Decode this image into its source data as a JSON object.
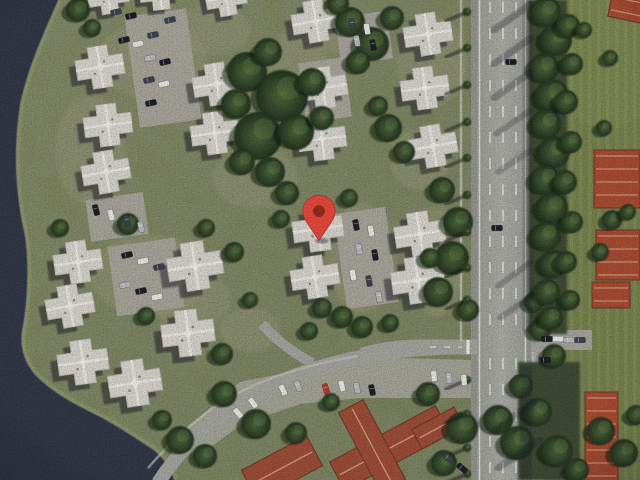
{
  "map": {
    "kind": "satellite-imagery",
    "marker": {
      "x": 319,
      "y": 218,
      "body_color": "#e8473a",
      "rim_color": "#b5352b",
      "dot_color": "#8e2418"
    },
    "palette": {
      "land_a": "#83865c",
      "land_b": "#747a51",
      "ground_patch": "#a69e7c",
      "water": "#2f3545",
      "water_edge": "#4a5370",
      "shore": "#8f9468",
      "grass_right": "#75814b",
      "grass_bright": "#7d8a50",
      "road": "#a4a49f",
      "road_shoulder": "#94948d",
      "lane": "#ffffff",
      "parking": "#a7a49a",
      "sidewalk": "#c6c3ba",
      "median_base": "#3c4a30",
      "building_roof": "#d7d5cd",
      "building_edge": "#b2b0a7",
      "building_ridge": "#efede6",
      "building_shadow": "rgba(22,26,36,0.5)",
      "red_roof": "#9c4b36",
      "red_roof_bright": "#a84a30",
      "red_ridge": "#dca88c",
      "red_edge": "#6f3425",
      "tree_shadow": "rgba(12,17,12,0.5)",
      "palm_canopy": "#2c4024",
      "car_colors": {
        "w": "#e9e9e7",
        "s": "#b9bcc0",
        "d": "#3a4150",
        "k": "#181c26",
        "r": "#b5382c"
      }
    },
    "water_shape": {
      "shore_line": "M58,0 C44,32 28,66 20,104 C13,148 15,192 24,232 C29,258 28,300 22,330 C19,348 25,364 36,376 C52,392 72,403 92,413 C113,423 133,437 152,449 C164,458 170,468 174,480",
      "lake_fill": "M0,0 L58,0 C44,32 28,66 20,104 C13,148 15,192 24,232 C29,258 28,300 22,330 C19,348 25,364 36,376 C52,392 72,403 92,413 C113,423 133,437 152,449 C164,458 170,468 174,480 L0,480 Z"
    },
    "ground_patches": [
      [
        152,
        60,
        55,
        38
      ],
      [
        150,
        275,
        60,
        40
      ],
      [
        362,
        258,
        34,
        55
      ],
      [
        350,
        34,
        32,
        24
      ],
      [
        255,
        178,
        42,
        30
      ],
      [
        432,
        62,
        35,
        45
      ],
      [
        436,
        262,
        26,
        55
      ],
      [
        90,
        150,
        35,
        55
      ],
      [
        190,
        300,
        40,
        30
      ],
      [
        300,
        70,
        30,
        45
      ],
      [
        420,
        160,
        30,
        30
      ],
      [
        210,
        30,
        40,
        25
      ],
      [
        250,
        330,
        30,
        22
      ]
    ],
    "parking_lots": [
      {
        "x": 132,
        "y": 12,
        "w": 62,
        "h": 112,
        "rot": -8
      },
      {
        "x": 88,
        "y": 196,
        "w": 58,
        "h": 42,
        "rot": -8
      },
      {
        "x": 112,
        "y": 242,
        "w": 68,
        "h": 70,
        "rot": -8
      },
      {
        "x": 340,
        "y": 210,
        "w": 52,
        "h": 96,
        "rot": -8
      },
      {
        "x": 338,
        "y": 14,
        "w": 52,
        "h": 48,
        "rot": -8
      },
      {
        "x": 302,
        "y": 60,
        "w": 46,
        "h": 60,
        "rot": -8
      },
      {
        "x": 536,
        "y": 330,
        "w": 56,
        "h": 20,
        "rot": 0
      }
    ],
    "parking_arc": "M182,432 L240,382 L330,364 L400,358 L472,360 L472,398 L360,398 L300,404 L242,424 L204,452 Z",
    "roads": {
      "highway_shoulder": {
        "x": 471,
        "w": 62
      },
      "highway": {
        "x": 477,
        "w": 50
      },
      "pocket": {
        "x": 531,
        "y": 316,
        "w": 12,
        "h": 164
      },
      "lane_xs": [
        490,
        503,
        516
      ],
      "edge_xs": [
        479.5,
        525.5
      ],
      "cross_path": "M477,347 L420,347 C400,347 380,350 362,355",
      "arc_path": "M158,483 C178,452 208,421 244,400 C282,378 322,364 366,356 C404,349 442,347 477,347",
      "stub_path": "M312,363 C292,352 276,340 262,324",
      "sidewalk_left": "M461,0 L461,342",
      "sidewalk_right": "M533,352 L533,480",
      "sidewalk_arc": "M148,468 C172,440 200,414 236,394 C270,376 310,364 358,356",
      "stop_bar": [
        468,
        340,
        468,
        354
      ],
      "cross_dashes": [
        430,
        347,
        462,
        347
      ]
    },
    "median_blocks": [
      [
        529,
        0,
        38,
        334
      ],
      [
        518,
        362,
        62,
        118
      ]
    ],
    "grass_right": {
      "x": 536,
      "w": 104
    },
    "grass_bright_patch": {
      "cx": 608,
      "cy": 55,
      "rx": 62,
      "ry": 72
    },
    "red_edge_buildings": [
      {
        "x": 610,
        "y": -6,
        "w": 34,
        "h": 26,
        "rot": 12
      },
      {
        "x": 594,
        "y": 150,
        "w": 46,
        "h": 58,
        "rot": 0
      },
      {
        "x": 596,
        "y": 230,
        "w": 44,
        "h": 50,
        "rot": 0
      },
      {
        "x": 592,
        "y": 282,
        "w": 38,
        "h": 26,
        "rot": 0
      },
      {
        "x": 585,
        "y": 392,
        "w": 33,
        "h": 92,
        "rot": 0
      }
    ],
    "red_complex": [
      {
        "cx": 390,
        "cy": 448,
        "w": 120,
        "h": 32,
        "rot": -28
      },
      {
        "cx": 372,
        "cy": 446,
        "w": 90,
        "h": 28,
        "rot": 62
      },
      {
        "cx": 438,
        "cy": 428,
        "w": 48,
        "h": 22,
        "rot": -28
      },
      {
        "cx": 282,
        "cy": 468,
        "w": 74,
        "h": 34,
        "rot": -28
      }
    ],
    "buildings": [
      {
        "x": 108,
        "y": -4,
        "rot": -9,
        "s": 0.85
      },
      {
        "x": 160,
        "y": -8,
        "rot": -6,
        "s": 0.85
      },
      {
        "x": 226,
        "y": -2,
        "rot": -10,
        "s": 0.85
      },
      {
        "x": 100,
        "y": 67,
        "rot": -9,
        "s": 1
      },
      {
        "x": 108,
        "y": 125,
        "rot": -7,
        "s": 1
      },
      {
        "x": 106,
        "y": 172,
        "rot": -10,
        "s": 1
      },
      {
        "x": 217,
        "y": 84,
        "rot": -9,
        "s": 1
      },
      {
        "x": 215,
        "y": 133,
        "rot": -8,
        "s": 1
      },
      {
        "x": 316,
        "y": 21,
        "rot": -10,
        "s": 1
      },
      {
        "x": 323,
        "y": 88,
        "rot": -9,
        "s": 1
      },
      {
        "x": 322,
        "y": 139,
        "rot": -7,
        "s": 1
      },
      {
        "x": 428,
        "y": 34,
        "rot": -9,
        "s": 1
      },
      {
        "x": 425,
        "y": 88,
        "rot": -8,
        "s": 1
      },
      {
        "x": 433,
        "y": 146,
        "rot": -10,
        "s": 1
      },
      {
        "x": 78,
        "y": 262,
        "rot": -8,
        "s": 1
      },
      {
        "x": 70,
        "y": 306,
        "rot": -10,
        "s": 1
      },
      {
        "x": 83,
        "y": 362,
        "rot": -8,
        "s": 1.05
      },
      {
        "x": 195,
        "y": 266,
        "rot": -9,
        "s": 1.15
      },
      {
        "x": 188,
        "y": 333,
        "rot": -7,
        "s": 1.1
      },
      {
        "x": 135,
        "y": 383,
        "rot": -9,
        "s": 1.1
      },
      {
        "x": 318,
        "y": 229,
        "rot": -8,
        "s": 1.05
      },
      {
        "x": 315,
        "y": 277,
        "rot": -9,
        "s": 1
      },
      {
        "x": 420,
        "y": 234,
        "rot": -9,
        "s": 1.05
      },
      {
        "x": 418,
        "y": 280,
        "rot": -8,
        "s": 1.1
      }
    ],
    "trees": [
      [
        247,
        72,
        20
      ],
      [
        282,
        96,
        26
      ],
      [
        258,
        136,
        24
      ],
      [
        296,
        132,
        18
      ],
      [
        236,
        104,
        15
      ],
      [
        312,
        82,
        14
      ],
      [
        268,
        52,
        14
      ],
      [
        322,
        118,
        12
      ],
      [
        242,
        162,
        13
      ],
      [
        270,
        172,
        15
      ],
      [
        350,
        22,
        15
      ],
      [
        372,
        44,
        17
      ],
      [
        392,
        18,
        12
      ],
      [
        358,
        62,
        12
      ],
      [
        338,
        4,
        11
      ],
      [
        388,
        128,
        14
      ],
      [
        404,
        152,
        11
      ],
      [
        378,
        106,
        10
      ],
      [
        287,
        193,
        12
      ],
      [
        281,
        219,
        9
      ],
      [
        349,
        198,
        9
      ],
      [
        442,
        190,
        13
      ],
      [
        458,
        222,
        15
      ],
      [
        452,
        258,
        17
      ],
      [
        438,
        292,
        15
      ],
      [
        468,
        310,
        11
      ],
      [
        430,
        258,
        10
      ],
      [
        322,
        308,
        10
      ],
      [
        342,
        317,
        11
      ],
      [
        362,
        327,
        11
      ],
      [
        390,
        323,
        9
      ],
      [
        309,
        331,
        9
      ],
      [
        128,
        224,
        11
      ],
      [
        146,
        316,
        9
      ],
      [
        60,
        228,
        9
      ],
      [
        222,
        354,
        11
      ],
      [
        234,
        252,
        10
      ],
      [
        206,
        228,
        9
      ],
      [
        250,
        300,
        8
      ],
      [
        78,
        10,
        12
      ],
      [
        92,
        28,
        9
      ],
      [
        180,
        440,
        14
      ],
      [
        162,
        420,
        10
      ],
      [
        205,
        456,
        12
      ],
      [
        224,
        394,
        13
      ],
      [
        256,
        424,
        15
      ],
      [
        296,
        433,
        11
      ],
      [
        331,
        402,
        9
      ],
      [
        428,
        394,
        12
      ],
      [
        462,
        428,
        16
      ],
      [
        444,
        463,
        13
      ],
      [
        498,
        420,
        15
      ],
      [
        517,
        443,
        17
      ],
      [
        538,
        412,
        14
      ],
      [
        557,
        451,
        16
      ],
      [
        577,
        470,
        12
      ],
      [
        601,
        431,
        14
      ],
      [
        624,
        453,
        14
      ],
      [
        636,
        415,
        10
      ],
      [
        540,
        330,
        11
      ],
      [
        554,
        356,
        12
      ],
      [
        521,
        386,
        12
      ],
      [
        534,
        302,
        10
      ],
      [
        546,
        12,
        15
      ],
      [
        556,
        40,
        16
      ],
      [
        544,
        68,
        15
      ],
      [
        552,
        96,
        17
      ],
      [
        546,
        124,
        15
      ],
      [
        554,
        152,
        16
      ],
      [
        545,
        180,
        15
      ],
      [
        552,
        208,
        16
      ],
      [
        546,
        236,
        15
      ],
      [
        553,
        264,
        14
      ],
      [
        547,
        292,
        13
      ],
      [
        551,
        318,
        12
      ],
      [
        568,
        26,
        12
      ],
      [
        572,
        64,
        11
      ],
      [
        566,
        102,
        12
      ],
      [
        571,
        142,
        11
      ],
      [
        565,
        182,
        12
      ],
      [
        572,
        222,
        11
      ],
      [
        566,
        262,
        11
      ],
      [
        570,
        300,
        10
      ],
      [
        584,
        30,
        8
      ],
      [
        604,
        128,
        8
      ],
      [
        612,
        220,
        10
      ],
      [
        600,
        252,
        9
      ],
      [
        628,
        212,
        8
      ],
      [
        610,
        58,
        8
      ]
    ],
    "palms": [
      [
        467,
        12
      ],
      [
        467,
        48
      ],
      [
        467,
        85
      ],
      [
        467,
        122
      ],
      [
        467,
        158
      ],
      [
        467,
        195
      ],
      [
        467,
        232
      ],
      [
        467,
        268
      ],
      [
        467,
        300
      ],
      [
        467,
        380
      ],
      [
        467,
        414
      ],
      [
        467,
        448
      ],
      [
        467,
        474
      ]
    ],
    "shadow_streaks": [
      [
        531,
        4,
        494,
        30,
        7,
        0.3
      ],
      [
        531,
        38,
        494,
        64,
        7,
        0.3
      ],
      [
        531,
        72,
        494,
        98,
        7,
        0.28
      ],
      [
        531,
        110,
        496,
        134,
        6,
        0.25
      ],
      [
        531,
        150,
        498,
        172,
        6,
        0.22
      ],
      [
        531,
        262,
        498,
        286,
        6,
        0.25
      ],
      [
        531,
        296,
        500,
        318,
        6,
        0.25
      ],
      [
        533,
        402,
        496,
        430,
        7,
        0.3
      ],
      [
        540,
        440,
        498,
        468,
        7,
        0.3
      ]
    ],
    "shadow_bands": [
      [
        523,
        0,
        9,
        332,
        0.25
      ],
      [
        520,
        366,
        12,
        114,
        0.25
      ]
    ],
    "cars": [
      [
        124,
        40,
        -12,
        "k"
      ],
      [
        138,
        44,
        -12,
        "w"
      ],
      [
        153,
        35,
        -12,
        "d"
      ],
      [
        150,
        58,
        -12,
        "s"
      ],
      [
        165,
        62,
        -12,
        "k"
      ],
      [
        149,
        80,
        -12,
        "d"
      ],
      [
        164,
        84,
        -12,
        "w"
      ],
      [
        151,
        103,
        -12,
        "k"
      ],
      [
        170,
        20,
        -12,
        "d"
      ],
      [
        116,
        12,
        -12,
        "d"
      ],
      [
        131,
        16,
        -12,
        "k"
      ],
      [
        352,
        24,
        80,
        "d"
      ],
      [
        367,
        29,
        80,
        "w"
      ],
      [
        373,
        45,
        80,
        "k"
      ],
      [
        357,
        41,
        80,
        "s"
      ],
      [
        96,
        210,
        75,
        "k"
      ],
      [
        111,
        215,
        75,
        "w"
      ],
      [
        127,
        221,
        75,
        "d"
      ],
      [
        141,
        227,
        75,
        "s"
      ],
      [
        127,
        255,
        -12,
        "k"
      ],
      [
        143,
        261,
        -12,
        "w"
      ],
      [
        159,
        267,
        -12,
        "d"
      ],
      [
        125,
        285,
        -12,
        "s"
      ],
      [
        141,
        291,
        -12,
        "k"
      ],
      [
        157,
        297,
        -12,
        "w"
      ],
      [
        356,
        225,
        80,
        "k"
      ],
      [
        371,
        231,
        80,
        "w"
      ],
      [
        359,
        249,
        80,
        "s"
      ],
      [
        375,
        255,
        80,
        "k"
      ],
      [
        353,
        275,
        80,
        "w"
      ],
      [
        369,
        281,
        80,
        "d"
      ],
      [
        379,
        297,
        80,
        "s"
      ],
      [
        238,
        413,
        50,
        "w"
      ],
      [
        253,
        403,
        54,
        "w"
      ],
      [
        283,
        390,
        66,
        "w"
      ],
      [
        298,
        386,
        69,
        "s"
      ],
      [
        326,
        389,
        73,
        "r"
      ],
      [
        342,
        386,
        75,
        "w"
      ],
      [
        357,
        388,
        77,
        "s"
      ],
      [
        372,
        390,
        78,
        "k"
      ],
      [
        434,
        376,
        85,
        "w"
      ],
      [
        449,
        378,
        86,
        "s"
      ],
      [
        464,
        380,
        86,
        "w"
      ],
      [
        448,
        458,
        40,
        "d"
      ],
      [
        462,
        468,
        40,
        "k"
      ],
      [
        547,
        339,
        0,
        "k"
      ],
      [
        558,
        339,
        0,
        "w"
      ],
      [
        569,
        340,
        0,
        "s"
      ],
      [
        580,
        340,
        0,
        "d"
      ],
      [
        511,
        62,
        0,
        "k"
      ],
      [
        497,
        228,
        0,
        "k"
      ],
      [
        545,
        360,
        0,
        "k"
      ]
    ]
  }
}
